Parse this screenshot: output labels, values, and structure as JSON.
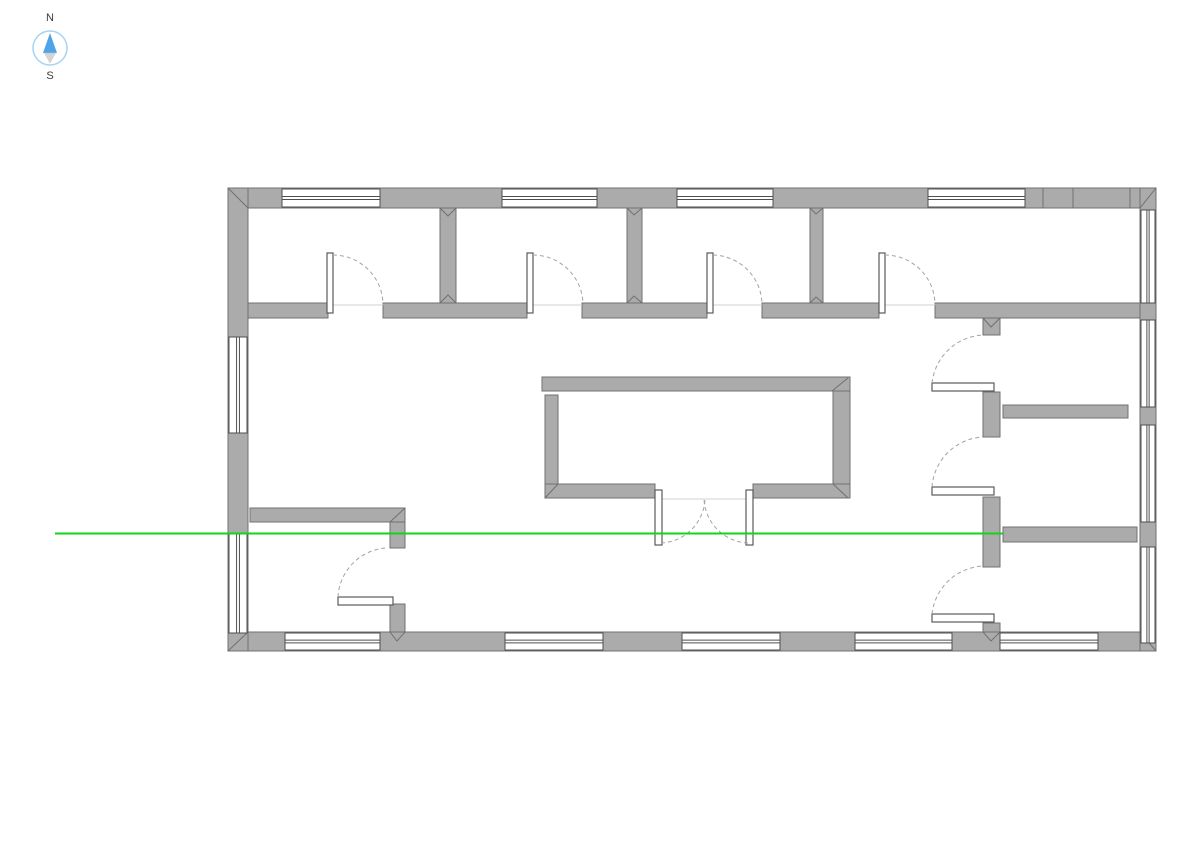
{
  "compass": {
    "north_label": "N",
    "south_label": "S"
  },
  "colors": {
    "background": "#ffffff",
    "wall_fill": "#ababab",
    "wall_stroke": "#707070",
    "window_fill": "#ffffff",
    "window_stroke": "#4f4f4f",
    "leaf_stroke": "#5a5a5a",
    "arc_stroke": "#a3a3a3",
    "threshold": "#d0d0d0",
    "section_line": "#12d412",
    "compass_ring": "#a6d3f2",
    "compass_north": "#4da4e8",
    "compass_south": "#d5d5d5",
    "label_color": "#3a3a3a"
  },
  "plan": {
    "walls": [
      {
        "name": "exterior-wall-north",
        "x": 228,
        "y": 188,
        "w": 928,
        "h": 20
      },
      {
        "name": "exterior-wall-south",
        "x": 228,
        "y": 632,
        "w": 928,
        "h": 19
      },
      {
        "name": "exterior-wall-west",
        "x": 228,
        "y": 188,
        "w": 20,
        "h": 463
      },
      {
        "name": "exterior-wall-east",
        "x": 1140,
        "y": 188,
        "w": 16,
        "h": 463
      },
      {
        "name": "corridor-wall-segment",
        "x": 248,
        "y": 303,
        "w": 80,
        "h": 15
      },
      {
        "name": "corridor-wall-segment",
        "x": 383,
        "y": 303,
        "w": 144,
        "h": 15
      },
      {
        "name": "corridor-wall-segment",
        "x": 582,
        "y": 303,
        "w": 125,
        "h": 15
      },
      {
        "name": "corridor-wall-segment",
        "x": 762,
        "y": 303,
        "w": 117,
        "h": 15
      },
      {
        "name": "corridor-wall-segment",
        "x": 935,
        "y": 303,
        "w": 205,
        "h": 15
      },
      {
        "name": "room-divider-wall",
        "x": 440,
        "y": 208,
        "w": 16,
        "h": 95
      },
      {
        "name": "room-divider-wall",
        "x": 627,
        "y": 208,
        "w": 15,
        "h": 95
      },
      {
        "name": "room-divider-wall",
        "x": 810,
        "y": 208,
        "w": 13,
        "h": 95
      },
      {
        "name": "east-hall-wall-segment",
        "x": 983,
        "y": 318,
        "w": 17,
        "h": 17
      },
      {
        "name": "east-hall-wall-segment",
        "x": 983,
        "y": 392,
        "w": 17,
        "h": 45
      },
      {
        "name": "east-hall-wall-segment",
        "x": 983,
        "y": 497,
        "w": 17,
        "h": 70
      },
      {
        "name": "east-hall-wall-segment",
        "x": 983,
        "y": 623,
        "w": 17,
        "h": 9
      },
      {
        "name": "core-wall-north",
        "x": 542,
        "y": 377,
        "w": 308,
        "h": 14
      },
      {
        "name": "core-wall-west",
        "x": 545,
        "y": 395,
        "w": 13,
        "h": 103
      },
      {
        "name": "core-wall-south-left",
        "x": 545,
        "y": 484,
        "w": 110,
        "h": 14
      },
      {
        "name": "core-wall-south-right",
        "x": 753,
        "y": 484,
        "w": 97,
        "h": 14
      },
      {
        "name": "core-wall-east",
        "x": 833,
        "y": 391,
        "w": 17,
        "h": 93
      },
      {
        "name": "sw-room-wall-north",
        "x": 250,
        "y": 508,
        "w": 155,
        "h": 14
      },
      {
        "name": "sw-room-wall-segment",
        "x": 390,
        "y": 522,
        "w": 15,
        "h": 26
      },
      {
        "name": "sw-room-wall-segment",
        "x": 390,
        "y": 604,
        "w": 15,
        "h": 28
      },
      {
        "name": "east-partition-wall",
        "x": 1003,
        "y": 405,
        "w": 125,
        "h": 13
      },
      {
        "name": "east-partition-wall",
        "x": 1003,
        "y": 527,
        "w": 134,
        "h": 15
      }
    ],
    "windows": [
      {
        "o": "h",
        "x": 282,
        "y": 189,
        "w": 98,
        "h": 18
      },
      {
        "o": "h",
        "x": 502,
        "y": 189,
        "w": 95,
        "h": 18
      },
      {
        "o": "h",
        "x": 677,
        "y": 189,
        "w": 96,
        "h": 18
      },
      {
        "o": "h",
        "x": 928,
        "y": 189,
        "w": 97,
        "h": 18
      },
      {
        "o": "h",
        "x": 285,
        "y": 633,
        "w": 95,
        "h": 17
      },
      {
        "o": "h",
        "x": 505,
        "y": 633,
        "w": 98,
        "h": 17
      },
      {
        "o": "h",
        "x": 682,
        "y": 633,
        "w": 98,
        "h": 17
      },
      {
        "o": "h",
        "x": 855,
        "y": 633,
        "w": 97,
        "h": 17
      },
      {
        "o": "h",
        "x": 1000,
        "y": 633,
        "w": 98,
        "h": 17
      },
      {
        "o": "v",
        "x": 229,
        "y": 337,
        "w": 18,
        "h": 96
      },
      {
        "o": "v",
        "x": 229,
        "y": 533,
        "w": 18,
        "h": 100
      },
      {
        "o": "v",
        "x": 1141,
        "y": 210,
        "w": 14,
        "h": 93
      },
      {
        "o": "v",
        "x": 1141,
        "y": 320,
        "w": 14,
        "h": 87
      },
      {
        "o": "v",
        "x": 1141,
        "y": 425,
        "w": 14,
        "h": 97
      },
      {
        "o": "v",
        "x": 1141,
        "y": 547,
        "w": 14,
        "h": 96
      }
    ],
    "door_leaves": [
      {
        "x": 327,
        "y": 253,
        "w": 6,
        "h": 60
      },
      {
        "x": 527,
        "y": 253,
        "w": 6,
        "h": 60
      },
      {
        "x": 707,
        "y": 253,
        "w": 6,
        "h": 60
      },
      {
        "x": 879,
        "y": 253,
        "w": 6,
        "h": 60
      },
      {
        "x": 655,
        "y": 490,
        "w": 7,
        "h": 55
      },
      {
        "x": 746,
        "y": 490,
        "w": 7,
        "h": 55
      },
      {
        "x": 932,
        "y": 383,
        "w": 62,
        "h": 8
      },
      {
        "x": 932,
        "y": 487,
        "w": 62,
        "h": 8
      },
      {
        "x": 932,
        "y": 614,
        "w": 62,
        "h": 8
      },
      {
        "x": 338,
        "y": 597,
        "w": 55,
        "h": 8
      }
    ],
    "door_arcs": [
      "M 333 255 A 50 50 0 0 1 383 305",
      "M 533 255 A 50 50 0 0 1 583 305",
      "M 713 255 A 50 50 0 0 1 762 305",
      "M 885 255 A 50 50 0 0 1 935 305",
      "M 661 543 A 46 46 0 0 0 705 499",
      "M 748 543 A 46 46 0 0 1 704 499",
      "M 932 383 A 54 54 0 0 1 983 335",
      "M 932 487 A 54 54 0 0 1 983 437",
      "M 932 614 A 54 54 0 0 1 983 566",
      "M 338 597 A 52 52 0 0 1 385 548"
    ],
    "thresholds": [
      {
        "x1": 333,
        "y1": 305,
        "x2": 383,
        "y2": 305
      },
      {
        "x1": 533,
        "y1": 305,
        "x2": 582,
        "y2": 305
      },
      {
        "x1": 713,
        "y1": 305,
        "x2": 762,
        "y2": 305
      },
      {
        "x1": 885,
        "y1": 305,
        "x2": 935,
        "y2": 305
      },
      {
        "x1": 662,
        "y1": 499,
        "x2": 746,
        "y2": 499
      }
    ],
    "seams": [
      "M228 188 L248 208",
      "M1156 188 L1140 208",
      "M228 651 L248 632",
      "M1156 651 L1140 632",
      "M440 208 L448 216 L456 208",
      "M440 303 L448 295 L456 303",
      "M627 208 L634 215 L642 208",
      "M627 303 L634 296 L642 303",
      "M810 208 L816 214 L823 208",
      "M810 303 L816 297 L823 303",
      "M983 318 L991 327 L1000 318",
      "M983 632 L991 641 L1000 632",
      "M390 632 L397 641 L405 632",
      "M390 522 L405 508",
      "M832 391 L848 378",
      "M545 498 L558 484",
      "M833 484 L848 498",
      "M1043 188 L1043 208",
      "M1073 188 L1073 208",
      "M1130 188 L1130 208"
    ],
    "section_line": {
      "x1": 55,
      "y1": 533.5,
      "x2": 1003,
      "y2": 533.5
    }
  }
}
